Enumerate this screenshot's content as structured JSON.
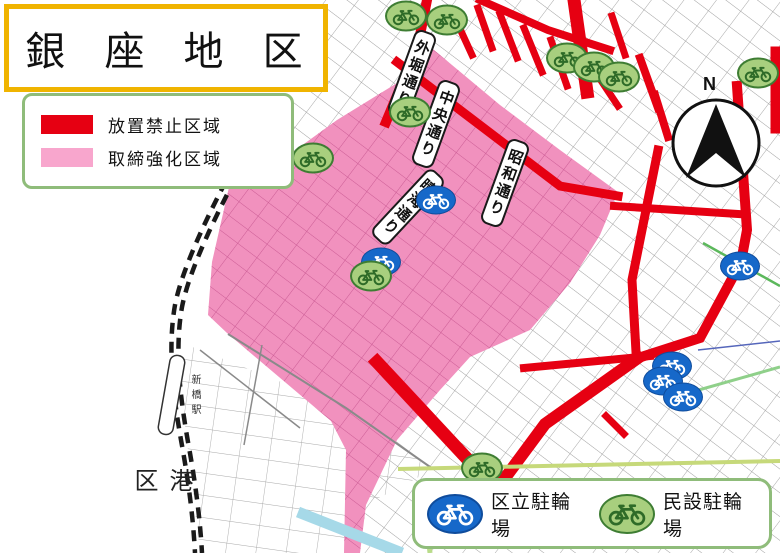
{
  "title": "銀 座 地 区",
  "zone_legend": [
    {
      "label": "放置禁止区域",
      "color": "#E60012"
    },
    {
      "label": "取締強化区域",
      "color": "#F8A6CD"
    }
  ],
  "parking_legend": [
    {
      "label": "区立駐輪場",
      "kind": "ward",
      "fill": "#1668C9"
    },
    {
      "label": "民設駐輪場",
      "kind": "private",
      "fill": "#A8CF7E"
    }
  ],
  "street_labels": [
    {
      "name": "外堀通り",
      "x": 412,
      "y": 74,
      "angle": 20
    },
    {
      "name": "中央通り",
      "x": 436,
      "y": 124,
      "angle": 20
    },
    {
      "name": "昭和通り",
      "x": 505,
      "y": 183,
      "angle": 20
    },
    {
      "name": "晴海通り",
      "x": 408,
      "y": 207,
      "angle": 43
    }
  ],
  "labels": {
    "minato_ward": "港区",
    "shimbashi_station": "新橋駅"
  },
  "compass_label": "N",
  "ward_parking_locations": [
    {
      "x": 436,
      "y": 200
    },
    {
      "x": 381,
      "y": 262
    },
    {
      "x": 740,
      "y": 266
    },
    {
      "x": 672,
      "y": 366
    },
    {
      "x": 663,
      "y": 381
    },
    {
      "x": 683,
      "y": 397
    }
  ],
  "private_parking_locations": [
    {
      "x": 406,
      "y": 16
    },
    {
      "x": 447,
      "y": 20
    },
    {
      "x": 567,
      "y": 58
    },
    {
      "x": 594,
      "y": 67
    },
    {
      "x": 619,
      "y": 77
    },
    {
      "x": 758,
      "y": 73
    },
    {
      "x": 410,
      "y": 112
    },
    {
      "x": 313,
      "y": 158
    },
    {
      "x": 371,
      "y": 276
    },
    {
      "x": 482,
      "y": 468
    }
  ]
}
